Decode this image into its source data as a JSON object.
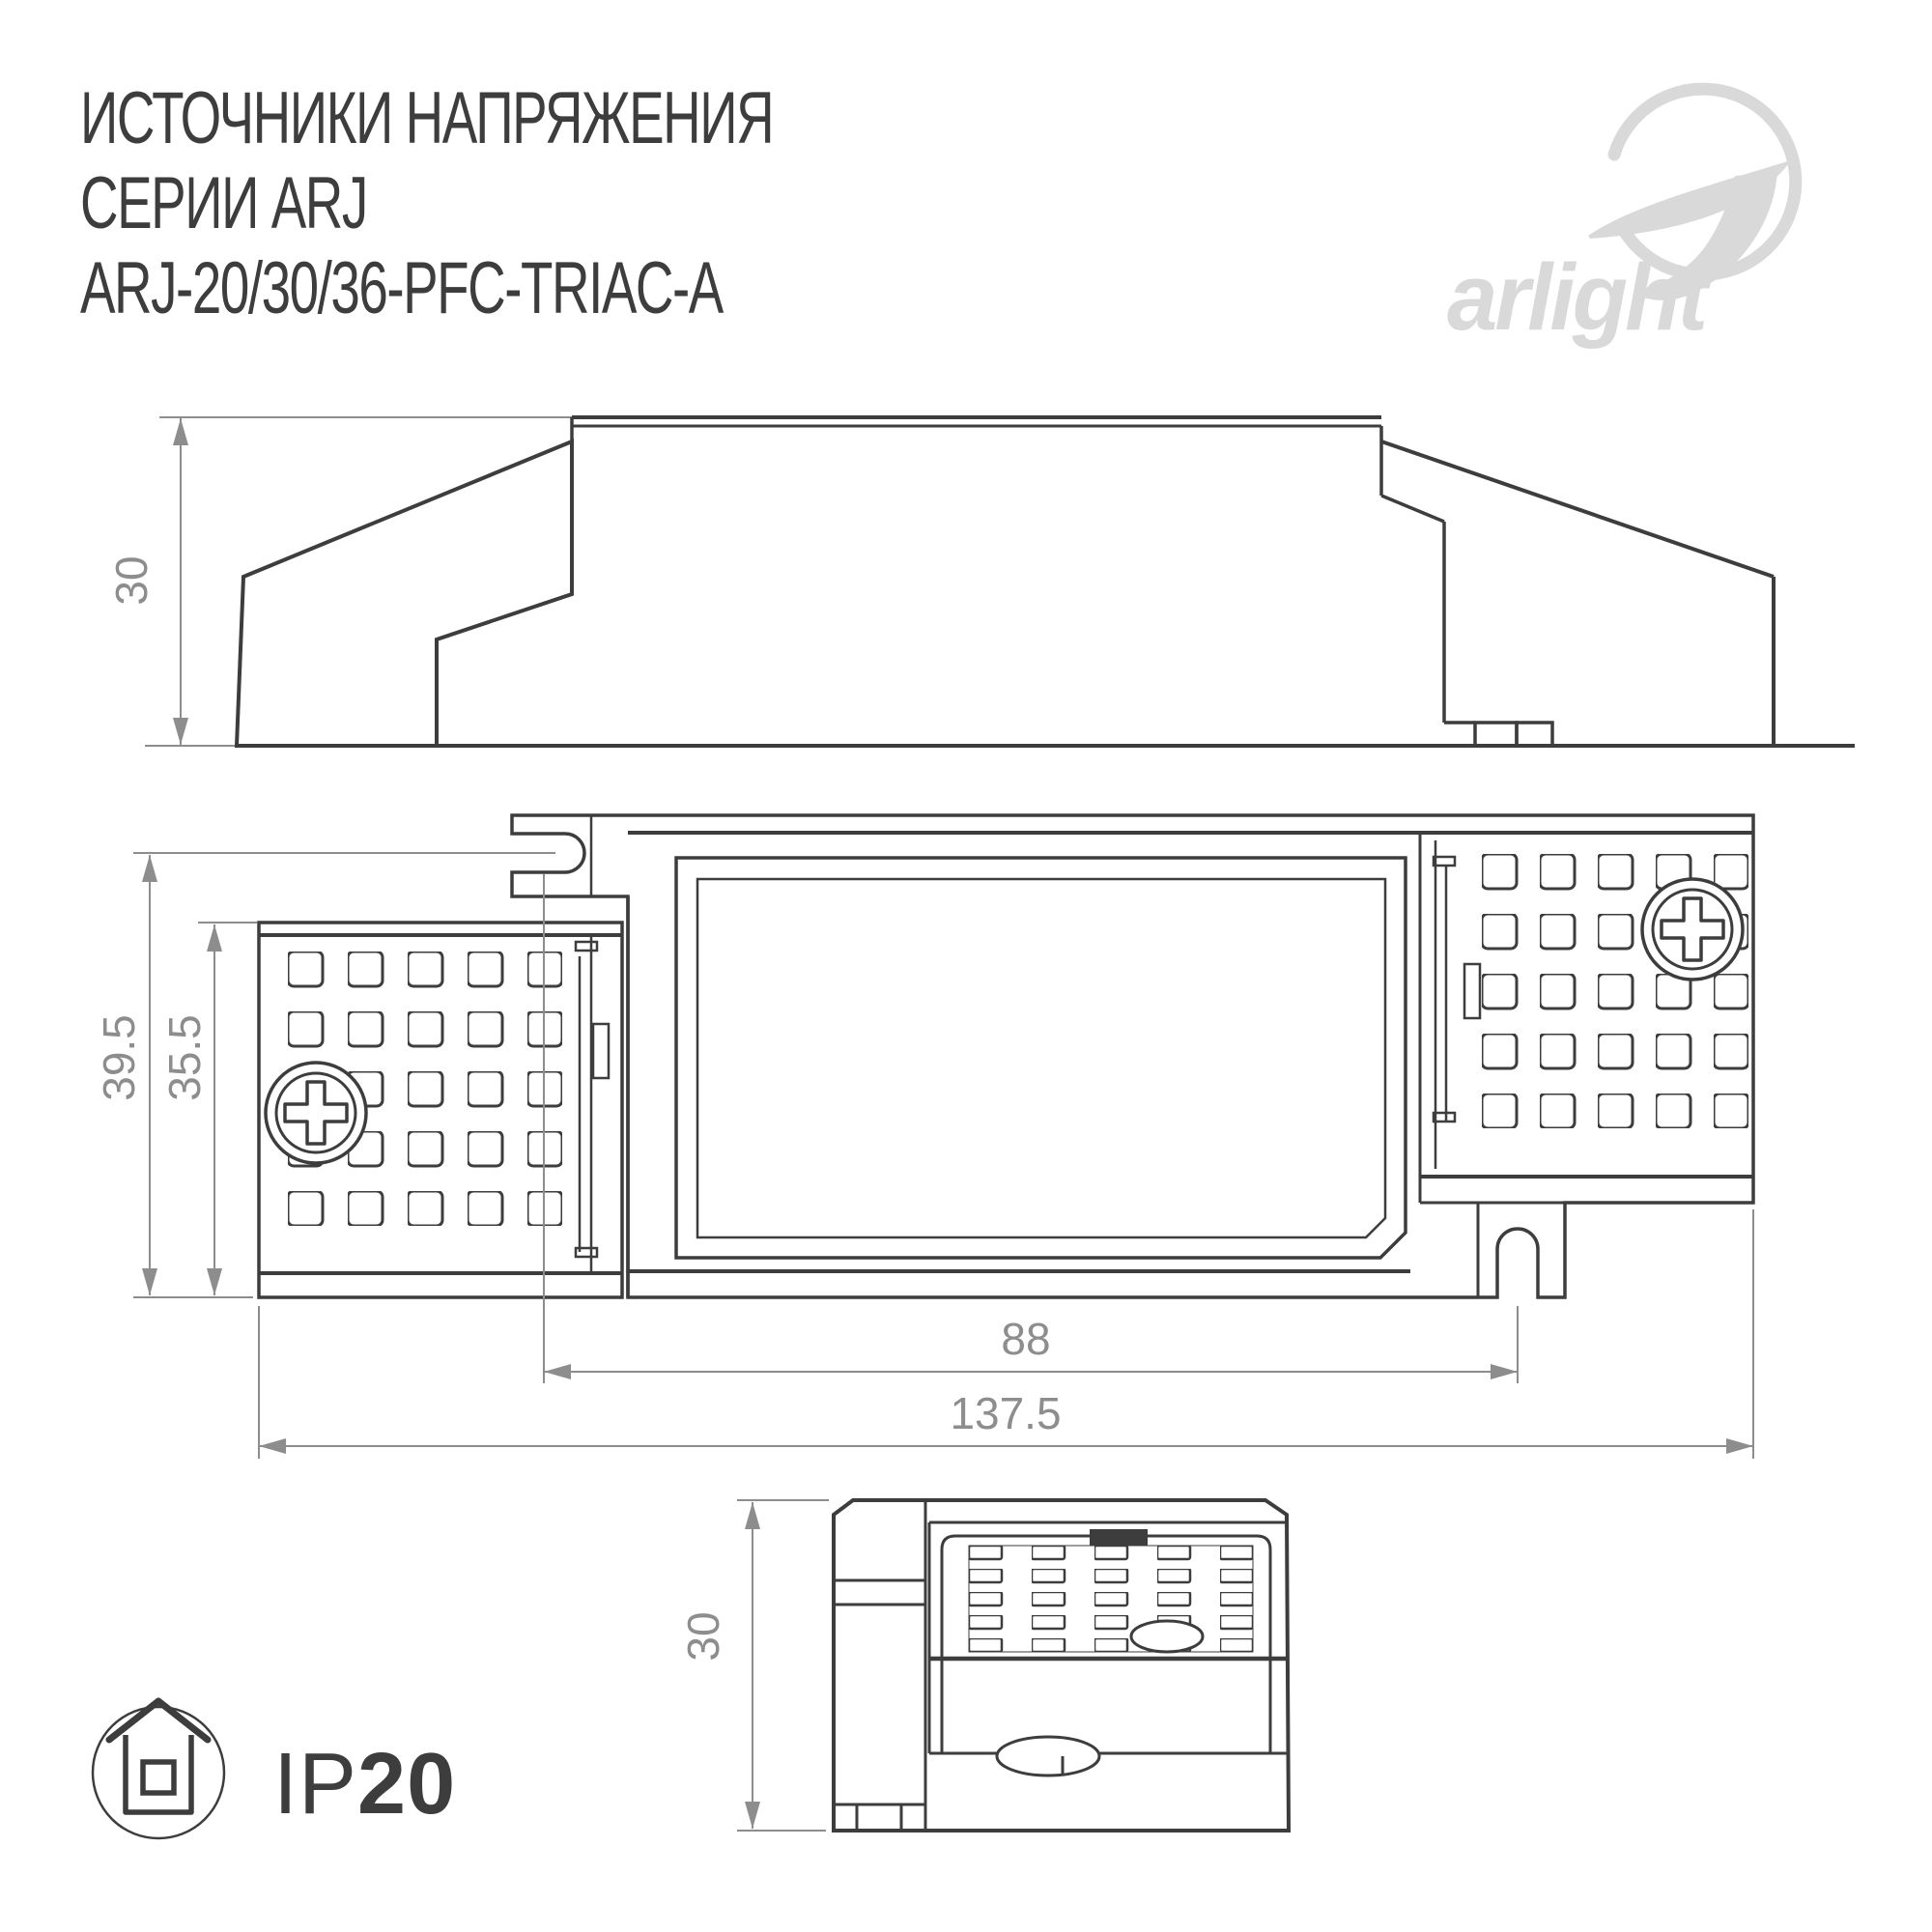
{
  "title": {
    "line1": "ИСТОЧНИКИ НАПРЯЖЕНИЯ",
    "line2": "СЕРИИ ARJ",
    "line3": "ARJ-20/30/36-PFC-TRIAC-A"
  },
  "brand": {
    "name": "arlight"
  },
  "dimensions": {
    "side_height": "30",
    "plan_overall_width": "39.5",
    "plan_terminal_width": "35.5",
    "plan_slot_distance": "88",
    "plan_overall_length": "137.5",
    "end_height": "30"
  },
  "protection": {
    "prefix": "IP",
    "value": "20"
  },
  "colors": {
    "line": "#3d3d3d",
    "dimension": "#8d8d8d",
    "logo": "#d9d9d9",
    "background": "#ffffff"
  }
}
